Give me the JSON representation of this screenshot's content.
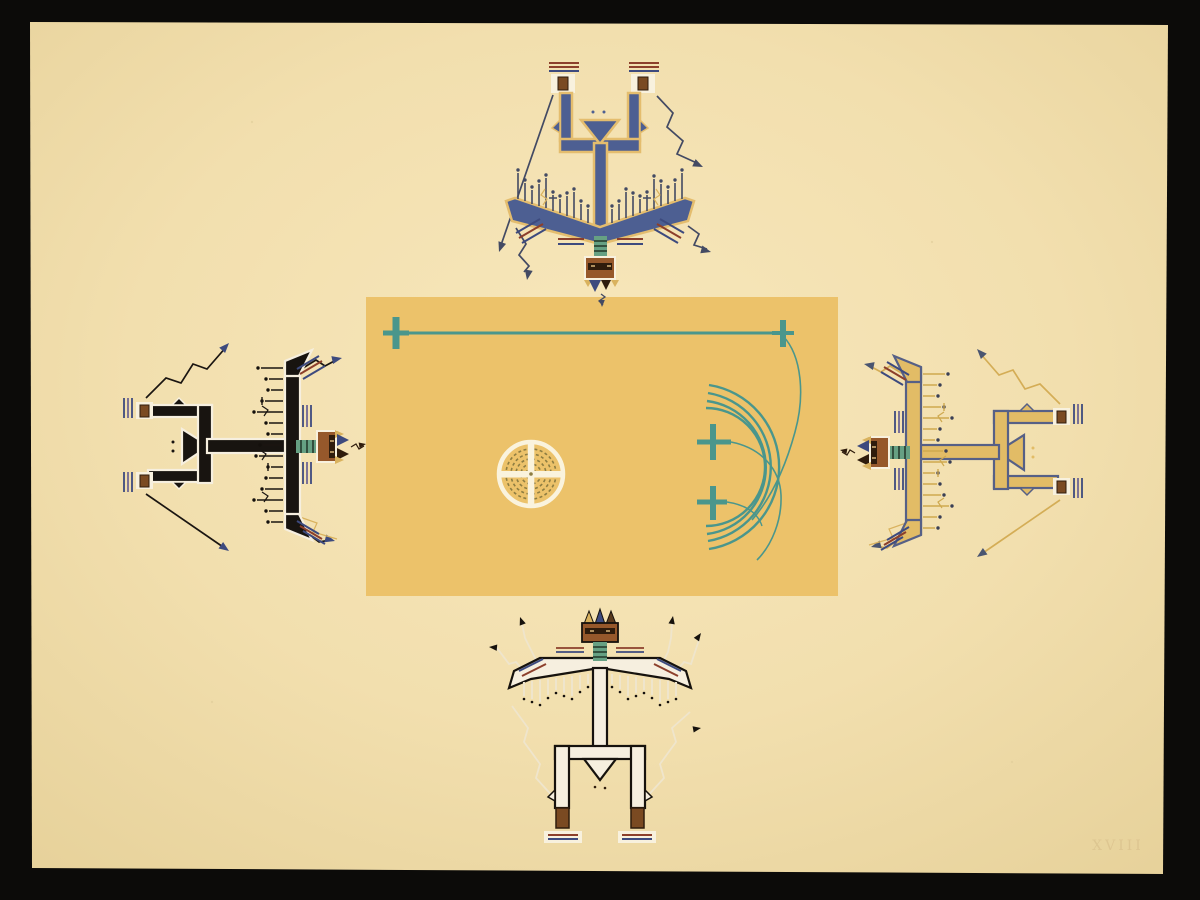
{
  "artwork": {
    "description": "Serigraph reproduction of a sandpainting: four spirit (thunder-being) figures arranged on the four sides of a central golden field, heads facing inward",
    "plate_number": "XVIII",
    "center_panel": {
      "motifs": [
        "long horizontal cord with cross ends",
        "two thin trailing cords with crosses",
        "four concentric arcs",
        "ringed water-circle with white cross"
      ]
    },
    "figures": [
      {
        "id": "north",
        "position": "top",
        "body": "blue",
        "outline": "gold"
      },
      {
        "id": "west",
        "position": "left",
        "body": "black",
        "outline": "white"
      },
      {
        "id": "east",
        "position": "right",
        "body": "gold",
        "outline": "blue"
      },
      {
        "id": "south",
        "position": "bottom",
        "body": "white",
        "outline": "black"
      }
    ]
  },
  "colors": {
    "bg": "#0c0b09",
    "paperHi": "#f7e7bb",
    "paperMid": "#f2dfae",
    "paperLo": "#e7d29b",
    "panel": "#ecc26a",
    "teal": "#4a968c",
    "olive": "#8d7d42",
    "ringWhite": "#faf3dd",
    "maroon": "#8c3f2b",
    "navy": "#3d4a7e",
    "purple": "#6f6694",
    "neckGreen": "#66a083",
    "neckDark": "#2c4636",
    "headBrown": "#96582b",
    "faceDark": "#2f1c0c",
    "boxWhite": "#f8f1de",
    "boxBrown": "#7a4a22",
    "yellowAccent": "#d9b25e",
    "hornBrown": "#5a3b1e",
    "eyeLight": "#d8b57a",
    "figN_body": "#4d5f92",
    "figN_outline": "#e4bd6e",
    "figN_ink": "#434a63",
    "figW_body": "#181410",
    "figW_outline": "#f6efdf",
    "figW_feather": "#1a1511",
    "figW_dot": "#14100c",
    "figW_zig": "#1a1511",
    "figW_arrow": "#3d4a7e",
    "figE_body": "#e2bc66",
    "figE_outline": "#566086",
    "figE_feather": "#cfa94f",
    "figE_dot": "#3a3f55",
    "figE_zig": "#d4ad56",
    "figE_arrow": "#4a5570",
    "figS_body": "#f6efdf",
    "figS_outline": "#16120d",
    "figS_zig": "#efe5cc",
    "figS_dot": "#14100c",
    "plate": "#d5bb87"
  }
}
